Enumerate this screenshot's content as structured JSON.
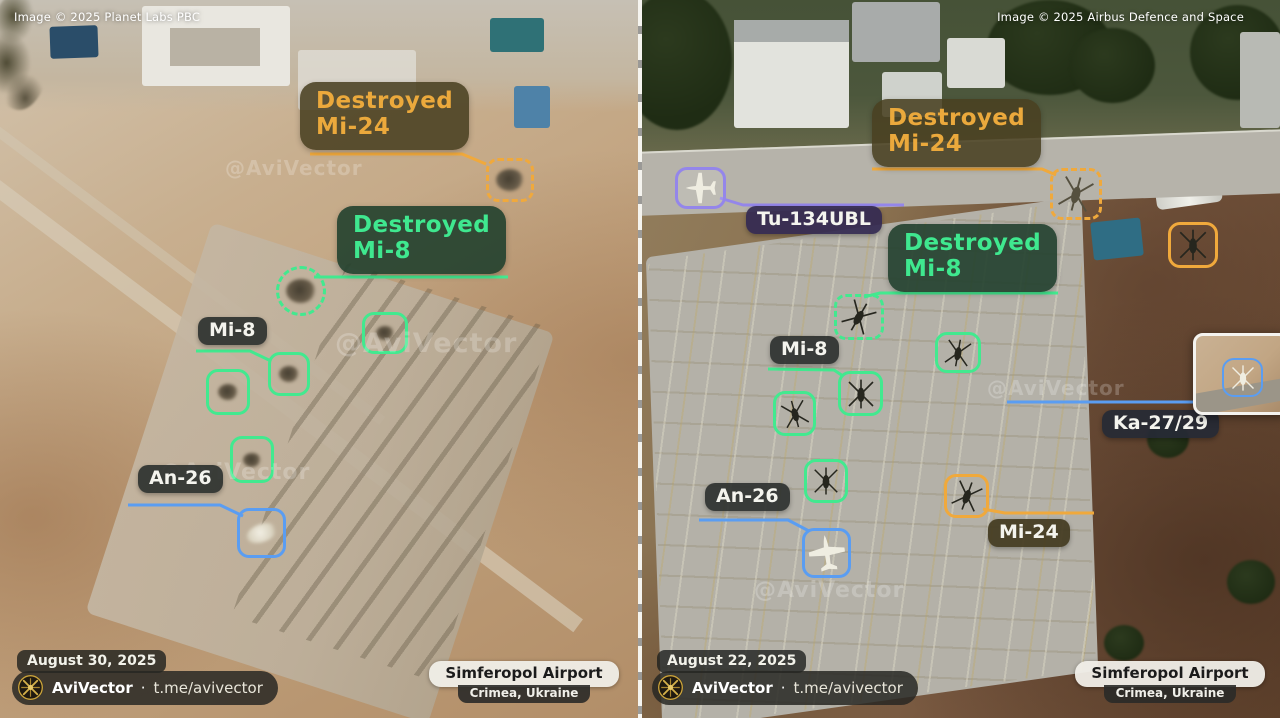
{
  "credits": {
    "left": "Image © 2025 Planet Labs PBC",
    "right": "Image © 2025 Airbus Defence and Space"
  },
  "ann": {
    "destroyed": "Destroyed",
    "mi24": "Mi-24",
    "mi8": "Mi-8",
    "an26": "An-26",
    "tu134ubl": "Tu-134UBL",
    "ka2729": "Ka-27/29"
  },
  "panels": {
    "left": {
      "date": "August 30, 2025"
    },
    "right": {
      "date": "August 22, 2025"
    }
  },
  "footer": {
    "brand": "AviVector",
    "separator": "·",
    "link": "t.me/avivector"
  },
  "location": {
    "name": "Simferopol Airport",
    "region": "Crimea, Ukraine"
  },
  "watermark": "@AviVector",
  "colors": {
    "destroyed_orange": "#f0a93c",
    "intact_green": "#42e98f",
    "an26_blue": "#5a9df2",
    "tu134_purple": "#9486ea",
    "logo_gold": "#c8a23c"
  }
}
